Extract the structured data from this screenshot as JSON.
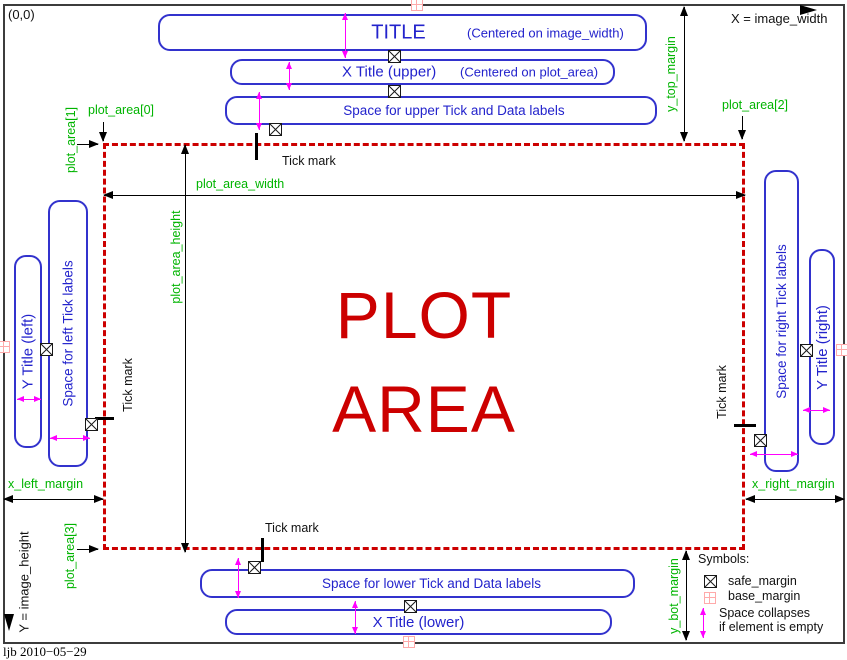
{
  "frame": {
    "origin_label": "(0,0)",
    "x_axis_label": "X = image_width",
    "y_axis_label": "Y = image_height",
    "credit": "ljb 2010−05−29"
  },
  "plot_area": {
    "word_line1": "PLOT",
    "word_line2": "AREA"
  },
  "top_boxes": {
    "title_label": "TITLE",
    "title_note": "(Centered on image_width)",
    "x_title_upper_label": "X Title (upper)",
    "x_title_upper_note": "(Centered on plot_area)",
    "space_upper_label": "Space for upper Tick and Data labels"
  },
  "bottom_boxes": {
    "space_lower_label": "Space for lower Tick and Data labels",
    "x_title_lower_label": "X Title (lower)"
  },
  "left_boxes": {
    "y_title_left_label": "Y Title (left)",
    "space_left_label": "Space for left Tick labels"
  },
  "right_boxes": {
    "space_right_label": "Space for right Tick labels",
    "y_title_right_label": "Y Title (right)"
  },
  "green_labels": {
    "plot_area_0": "plot_area[0]",
    "plot_area_1": "plot_area[1]",
    "plot_area_2": "plot_area[2]",
    "plot_area_3": "plot_area[3]",
    "plot_area_width": "plot_area_width",
    "plot_area_height": "plot_area_height",
    "x_left_margin": "x_left_margin",
    "x_right_margin": "x_right_margin",
    "y_top_margin": "y_top_margin",
    "y_bot_margin": "y_bot_margin"
  },
  "tick_labels": {
    "top": "Tick mark",
    "left": "Tick mark",
    "right": "Tick mark",
    "bottom": "Tick mark"
  },
  "legend": {
    "title": "Symbols:",
    "safe_margin_label": "safe_margin",
    "base_margin_label": "base_margin",
    "collapse_line1": "Space collapses",
    "collapse_line2": "if element is empty"
  },
  "colors": {
    "blue": "#3232cd",
    "bluetext": "#2323cc",
    "green": "#00b400",
    "red": "#cc0000",
    "magenta": "#ff00ff",
    "pink": "#ffaaaa"
  }
}
